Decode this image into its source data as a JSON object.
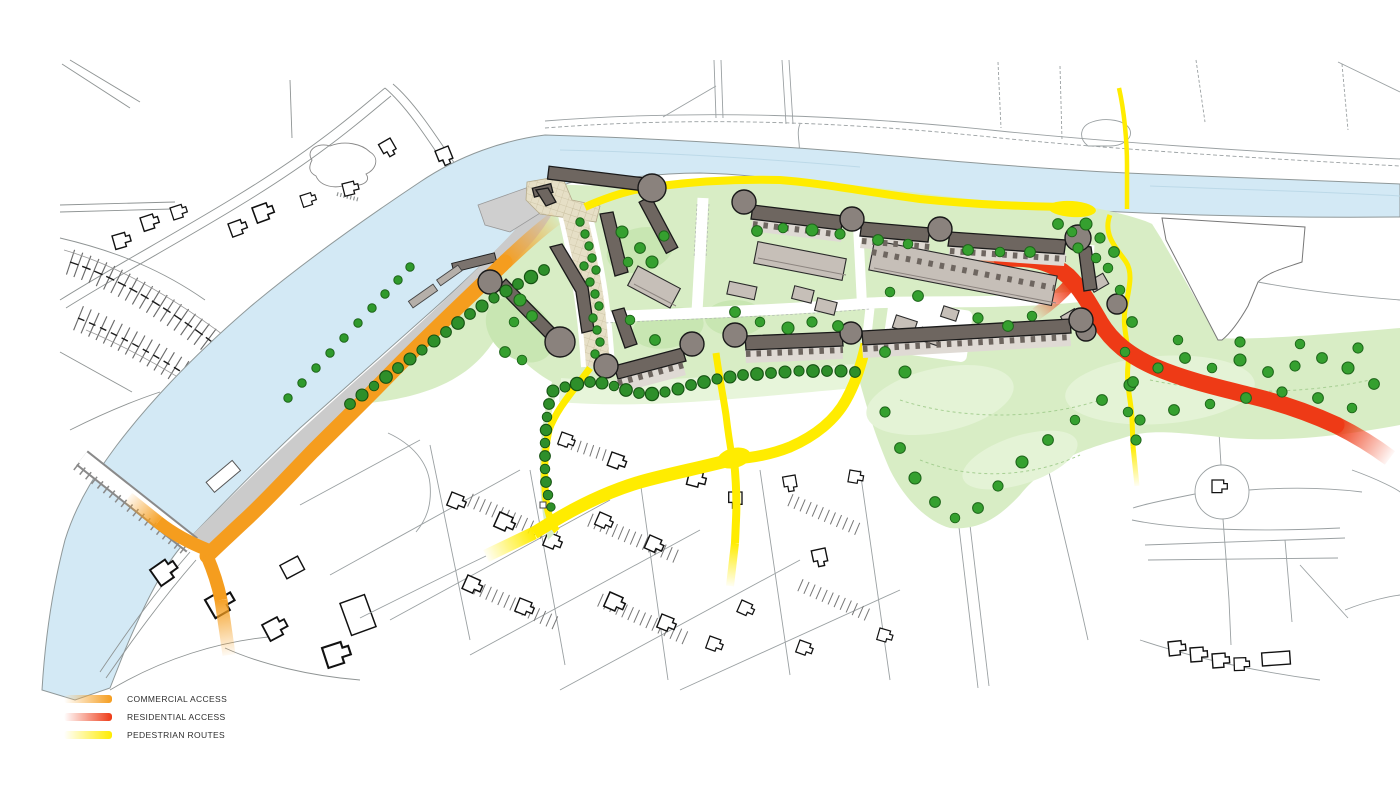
{
  "page": {
    "type": "masterplan-access-map",
    "background": "#ffffff"
  },
  "legend": {
    "items": [
      {
        "id": "commercial-access",
        "label": "COMMERCIAL ACCESS",
        "color": "#F59D1E"
      },
      {
        "id": "residential-access",
        "label": "RESIDENTIAL ACCESS",
        "color": "#EE3A16"
      },
      {
        "id": "pedestrian-routes",
        "label": "PEDESTRIAN ROUTES",
        "color": "#FFEC00"
      }
    ]
  },
  "map": {
    "features": {
      "river": {
        "color": "#D3E9F5"
      },
      "site_green": {
        "color": "#D8EDC5"
      },
      "trees": {
        "color": "#35A02F"
      },
      "apartment_blocks": {
        "color": "#6E6660"
      },
      "terrace_houses": {
        "color": "#C6BFB8"
      },
      "plaza": {
        "color": "#E6DFC6"
      },
      "promenade": {
        "color": "#CBCBCB"
      },
      "context_linework": {
        "color": "#8F9494"
      }
    },
    "routes": [
      {
        "id": "commercial-access",
        "color": "#F59D1E"
      },
      {
        "id": "residential-access",
        "color": "#EE3A16"
      },
      {
        "id": "pedestrian-routes",
        "color": "#FFEC00"
      }
    ]
  }
}
